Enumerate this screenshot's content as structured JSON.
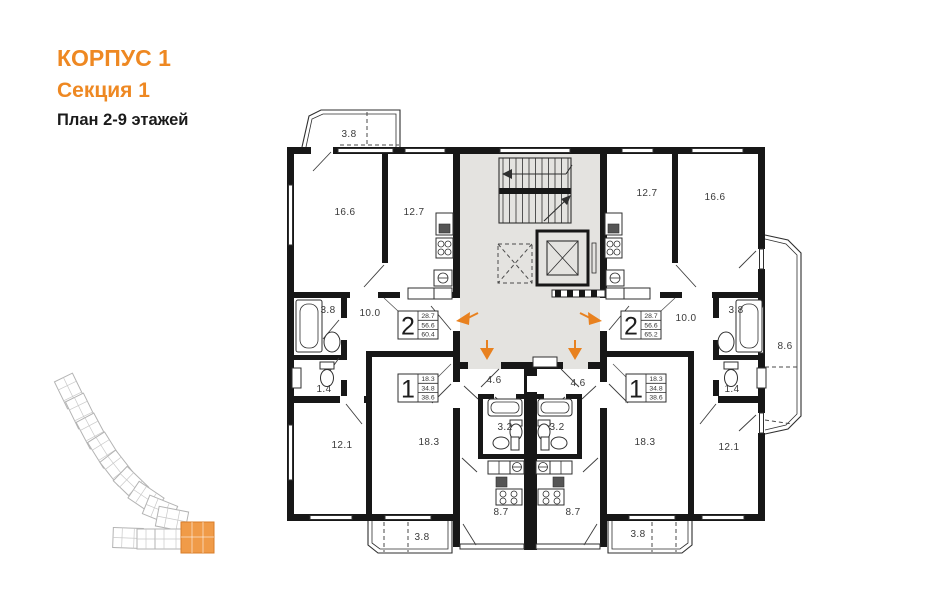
{
  "header": {
    "building": "КОРПУС 1",
    "section": "Секция 1",
    "plan": "План 2-9 этажей"
  },
  "apartments": {
    "apt_2_left": {
      "type": "2",
      "living": "28.7",
      "total": "56.6",
      "overall": "60.4"
    },
    "apt_2_right": {
      "type": "2",
      "living": "28.7",
      "total": "56.6",
      "overall": "65.2"
    },
    "apt_1_left": {
      "type": "1",
      "living": "18.3",
      "total": "34.8",
      "overall": "38.6"
    },
    "apt_1_right": {
      "type": "1",
      "living": "18.3",
      "total": "34.8",
      "overall": "38.6"
    }
  },
  "room_areas": {
    "balcony_top_left": "3.8",
    "room_16_left": "16.6",
    "kitchen_12_left": "12.7",
    "bath_left": "3.8",
    "hall_left": "10.0",
    "wc_left": "1.4",
    "room_12_left": "12.1",
    "room_18_left": "18.3",
    "hall_small_left": "4.6",
    "bath_small_left": "3.2",
    "kitchen_small_left": "8.7",
    "balcony_bottom_left": "3.8",
    "kitchen_12_right": "12.7",
    "room_16_right": "16.6",
    "bath_right": "3.8",
    "hall_right": "10.0",
    "wc_right": "1.4",
    "room_12_right": "12.1",
    "room_18_right": "18.3",
    "hall_small_right": "4.6",
    "bath_small_right": "3.2",
    "kitchen_small_right": "8.7",
    "balcony_bottom_right": "3.8",
    "balcony_side_right": "8.6"
  },
  "colors": {
    "accent": "#ee8822",
    "arrow": "#e8811f",
    "core_fill": "#e4e3e0",
    "wall": "#171717",
    "map_highlight": "#f09b48"
  }
}
